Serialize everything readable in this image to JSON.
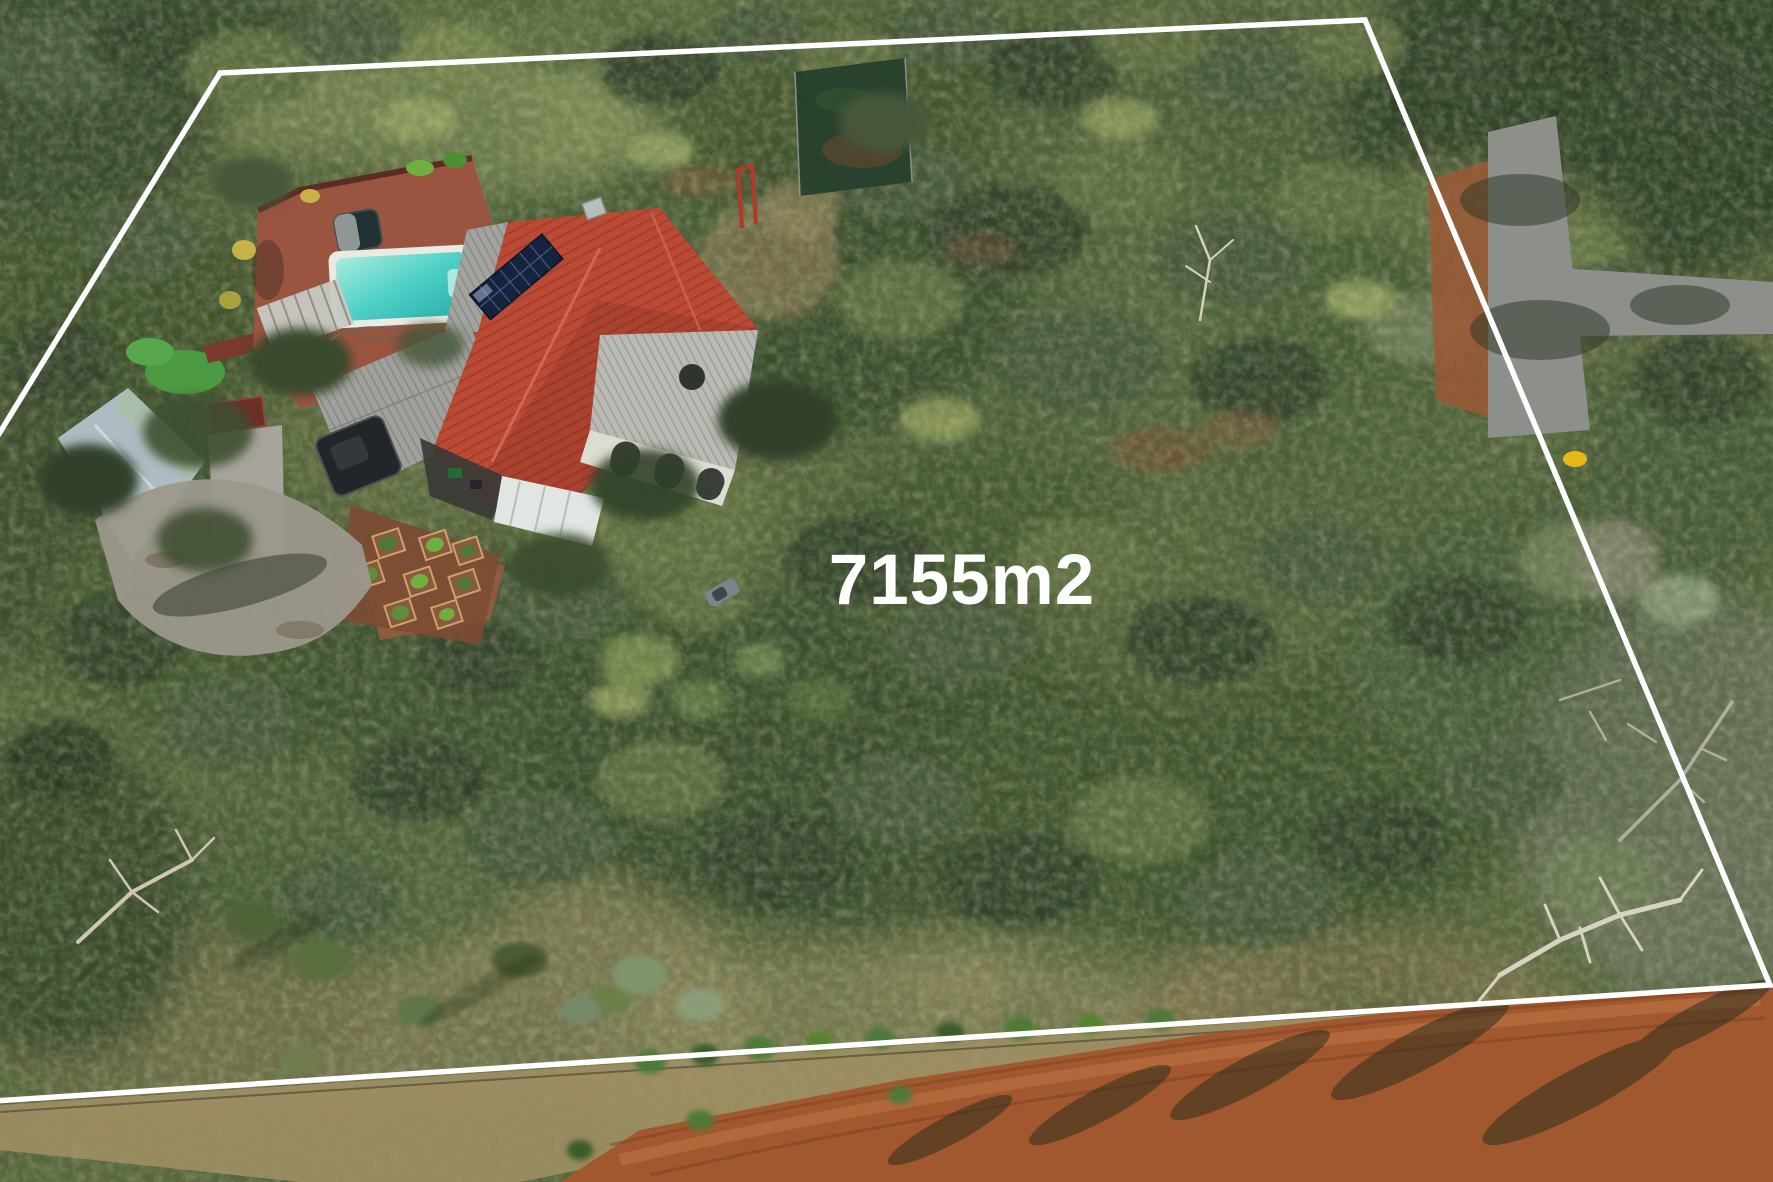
{
  "annotation": {
    "area_label": "7155m2"
  },
  "palette": {
    "boundary": "#ffffff",
    "label": "#ffffff",
    "canopy_base": "#5e6a40",
    "roof_red": "#bb4a35",
    "roof_red_shade": "#9d3c2c",
    "grey_roof": "#a0a19c",
    "pool_coping": "#e9ebe3",
    "paving_red": "#9a5540",
    "dirt_road": "#a2582f",
    "asphalt": "#8d8f8a",
    "driveway": "#9c988c",
    "solar_panel": "#16233f"
  }
}
